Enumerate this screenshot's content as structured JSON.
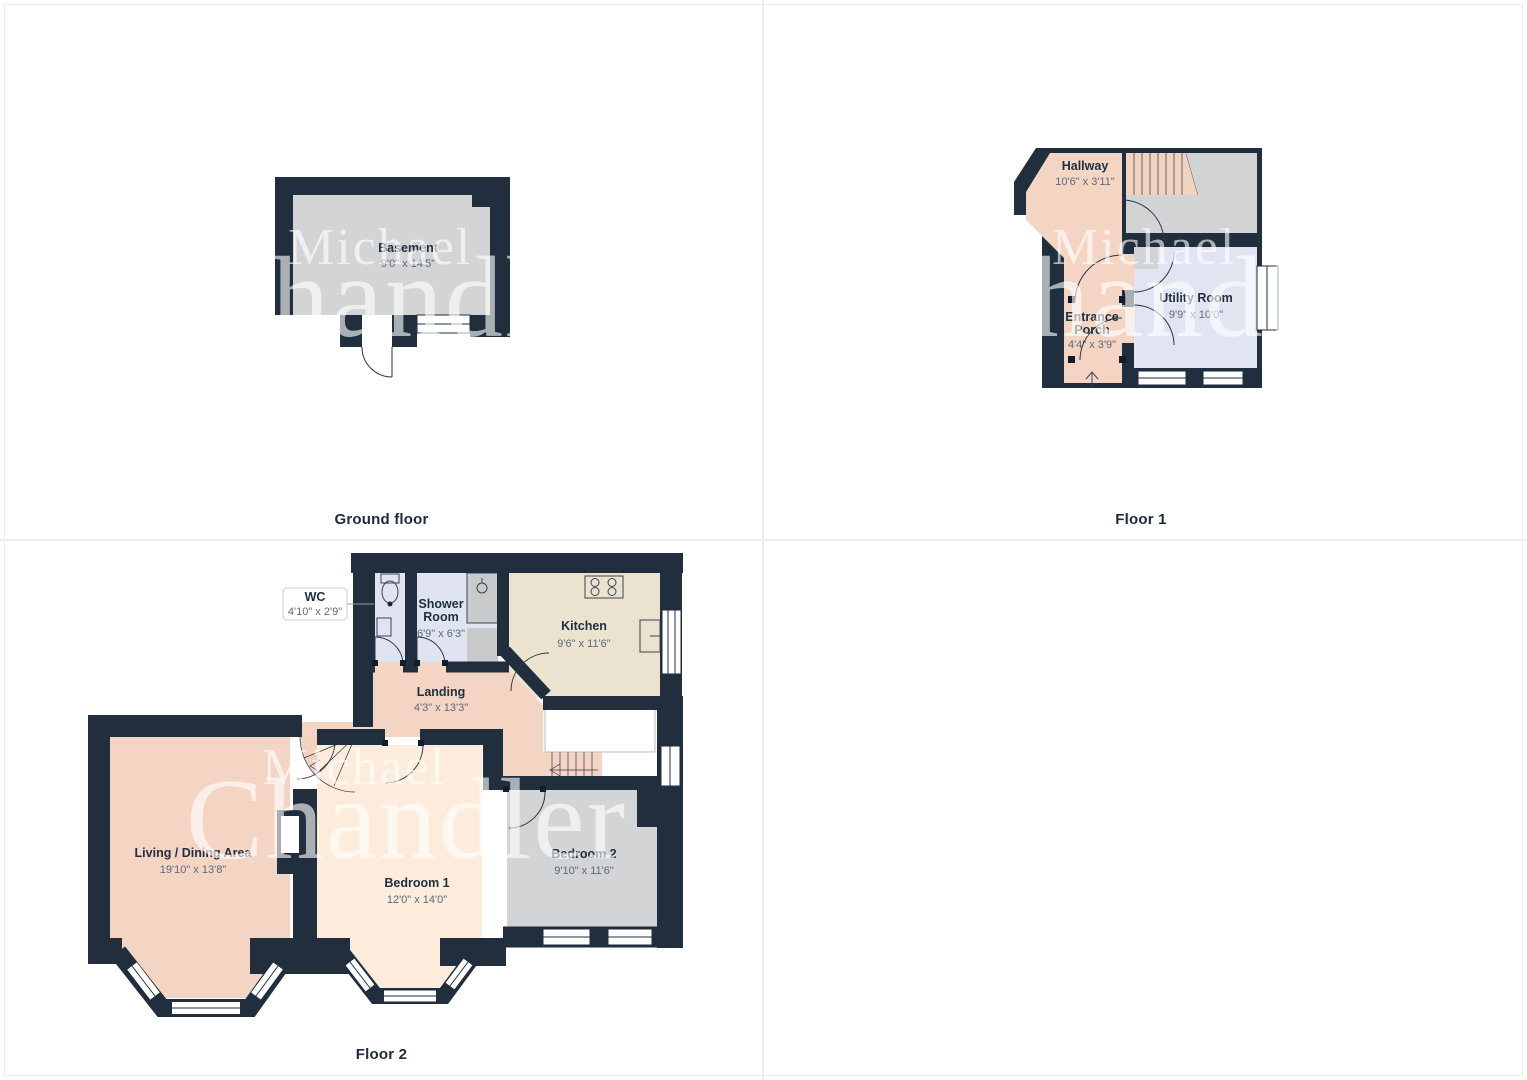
{
  "page": {
    "background": "#ffffff",
    "grid_color": "#ececec"
  },
  "colors": {
    "wall": "#202e3e",
    "salmon_room": "#f4d5c4",
    "cream_room": "#fdecdb",
    "tan_room": "#ebe3cf",
    "gray_room": "#d3d4d6",
    "blue_room": "#dfe4f0",
    "cupboard_gray": "#c8cacc",
    "room_name_text": "#20303f",
    "room_dims_text": "#5d6878"
  },
  "watermark": {
    "line1": "Michael",
    "line2": "Chandler"
  },
  "floors": {
    "ground": {
      "label": "Ground floor",
      "rooms": {
        "basement": {
          "name": "Basement",
          "dims": "9'0\" x 14'5\""
        }
      }
    },
    "floor1": {
      "label": "Floor 1",
      "rooms": {
        "hallway": {
          "name": "Hallway",
          "dims": "10'6\" x 3'11\""
        },
        "entrance_porch": {
          "line1": "Entrance",
          "line2": "Porch",
          "dims": "4'4\" x 3'9\""
        },
        "utility": {
          "name": "Utility Room",
          "dims": "9'9\" x 10'0\""
        }
      }
    },
    "floor2": {
      "label": "Floor 2",
      "rooms": {
        "wc": {
          "name": "WC",
          "dims": "4'10\" x 2'9\""
        },
        "shower": {
          "line1": "Shower",
          "line2": "Room",
          "dims": "6'9\" x 6'3\""
        },
        "kitchen": {
          "name": "Kitchen",
          "dims": "9'6\" x 11'6\""
        },
        "landing": {
          "name": "Landing",
          "dims": "4'3\" x 13'3\""
        },
        "living": {
          "name": "Living / Dining Area",
          "dims": "19'10\" x 13'8\""
        },
        "bedroom1": {
          "name": "Bedroom 1",
          "dims": "12'0\" x 14'0\""
        },
        "bedroom2": {
          "name": "Bedroom 2",
          "dims": "9'10\" x 11'6\""
        }
      }
    }
  }
}
